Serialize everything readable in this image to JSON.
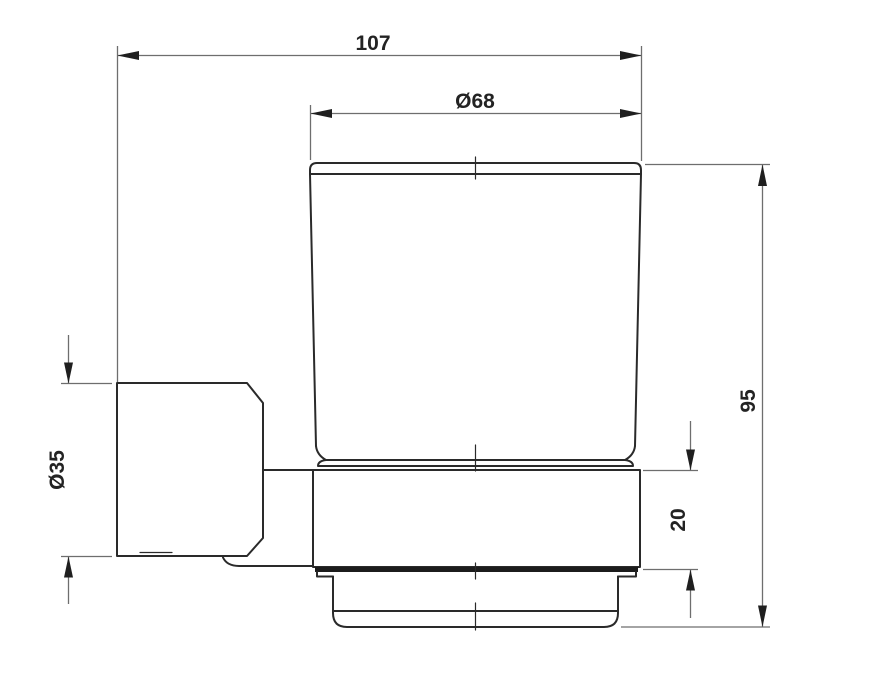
{
  "drawing": {
    "title": "Wall-mounted glass tumbler holder - dimensioned side view",
    "dims": {
      "overall_width": "107",
      "cup_diameter": "Ø68",
      "overall_height": "95",
      "holder_ring_height": "20",
      "bracket_diameter": "Ø35"
    },
    "colors": {
      "background": "#ffffff",
      "outline": "#2a2a2a",
      "dimension_line": "#6e6e6e",
      "arrow": "#1f1f1f",
      "text": "#232323"
    }
  }
}
